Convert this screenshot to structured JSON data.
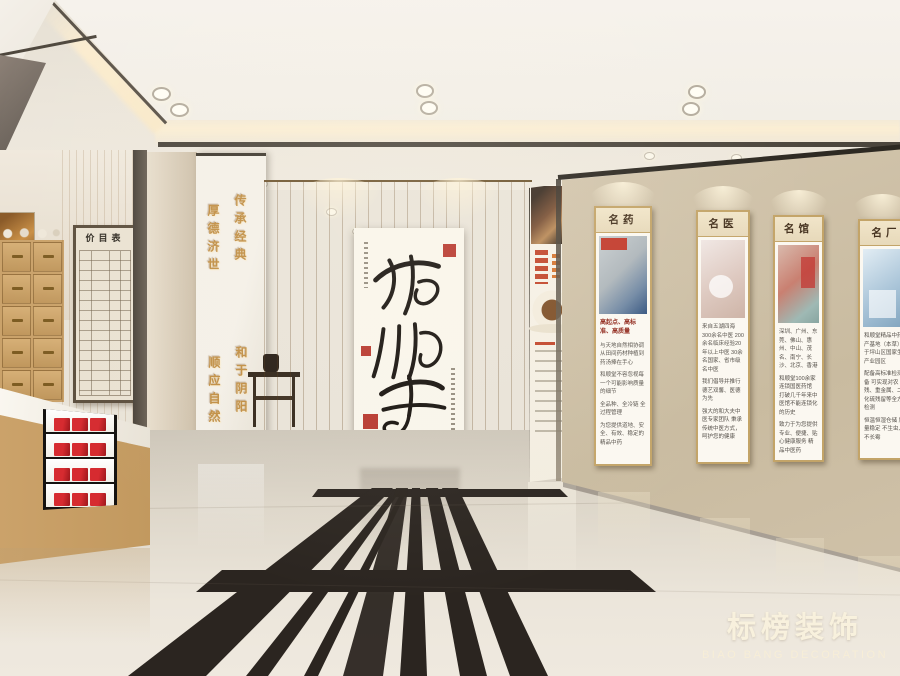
{
  "calligraphy_scroll": {
    "text": "和顺堂"
  },
  "partition_slogans": {
    "upper_right": "传承经典",
    "upper_left": "厚德济世",
    "lower_right": "和于阴阳",
    "lower_left": "顺应自然"
  },
  "price_board": {
    "title": "价目表"
  },
  "posters": [
    {
      "header": "名药",
      "heading": "高起点、高标准、高质量",
      "paragraphs": [
        "与天地自然相协调 从田间药材种植到药汤捧在手心",
        "和顺堂不容忽视每一个可能影响质量的细节",
        "全品种、全冷链 全过程管理",
        "为您提供道地、安全、有效、稳定的精品中药"
      ]
    },
    {
      "header": "名医",
      "heading": "",
      "paragraphs": [
        "来自五湖四海 300余名中医 200余名临床经验20年以上中医 30余名国家、省市级名中医",
        "我们倡导并推行 德艺双馨、医德为先",
        "强大的和大夫中医专家团队 秉承传统中医方式，呵护您的健康"
      ]
    },
    {
      "header": "名馆",
      "heading": "",
      "paragraphs": [
        "深圳、广州、东莞、佛山、惠州、中山、茂名、南宁、长沙、北京、香港",
        "和顺堂100余家连锁国医药馆 打破几千年来中医馆不能连锁化的历史",
        "致力于为您提供专业、便捷、贴心健康服务 精品中医药"
      ]
    },
    {
      "header": "名厂",
      "heading": "",
      "paragraphs": [
        "和顺堂精品中药生产基地（本草）位于坪山区国家生物产业园区",
        "配备高标准检测设备 可实现对农残、重金属、二氧化硫残留等全方位检测",
        "恒温恒湿仓储 质量稳定 不生虫、不长霉"
      ]
    }
  ],
  "watermark": {
    "cn": "标榜装饰",
    "en": "BIAO BANG DECORATION"
  },
  "colors": {
    "wood": "#c89f66",
    "wall_beige": "#cfc2a8",
    "accent_red": "#c32127",
    "gold_lettering": "#c08d42",
    "ink": "#1a1512",
    "floor": "#e8e2d7",
    "floor_inlay": "#2b2520"
  }
}
